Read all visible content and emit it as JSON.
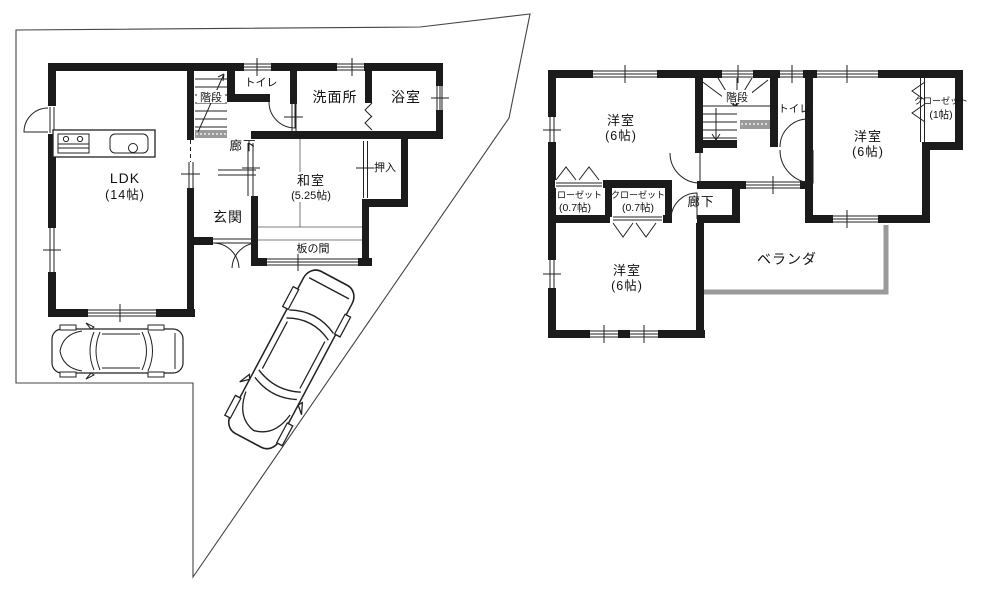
{
  "title": "間取り図",
  "first_floor": {
    "rooms": {
      "ldk": {
        "label": "LDK",
        "size": "(14帖)"
      },
      "washitsu": {
        "label": "和室",
        "size": "(5.25帖)"
      },
      "genkan": {
        "label": "玄関"
      },
      "rouka": {
        "label": "廊下"
      },
      "kaidan": {
        "label": "階段"
      },
      "toilet": {
        "label": "トイレ"
      },
      "senmenjo": {
        "label": "洗面所"
      },
      "yokushitsu": {
        "label": "浴室"
      },
      "oshiire": {
        "label": "押入"
      },
      "itanoma": {
        "label": "板の間"
      }
    }
  },
  "second_floor": {
    "rooms": {
      "yoshitsu_nw": {
        "label": "洋室",
        "size": "(6帖)"
      },
      "yoshitsu_e": {
        "label": "洋室",
        "size": "(6帖)"
      },
      "yoshitsu_sw": {
        "label": "洋室",
        "size": "(6帖)"
      },
      "kaidan": {
        "label": "階段"
      },
      "toilet": {
        "label": "トイレ"
      },
      "closet_e": {
        "label": "クローゼット",
        "size": "(1帖)"
      },
      "closet_w1": {
        "label": "クローゼット",
        "size": "(0.7帖)"
      },
      "closet_w2": {
        "label": "クローゼット",
        "size": "(0.7帖)"
      },
      "rouka": {
        "label": "廊下"
      },
      "veranda": {
        "label": "ベランダ"
      }
    }
  },
  "colors": {
    "wall": "#1b1b1b",
    "line": "#222222",
    "veranda_rail": "#9a9a9a",
    "background": "#ffffff"
  }
}
